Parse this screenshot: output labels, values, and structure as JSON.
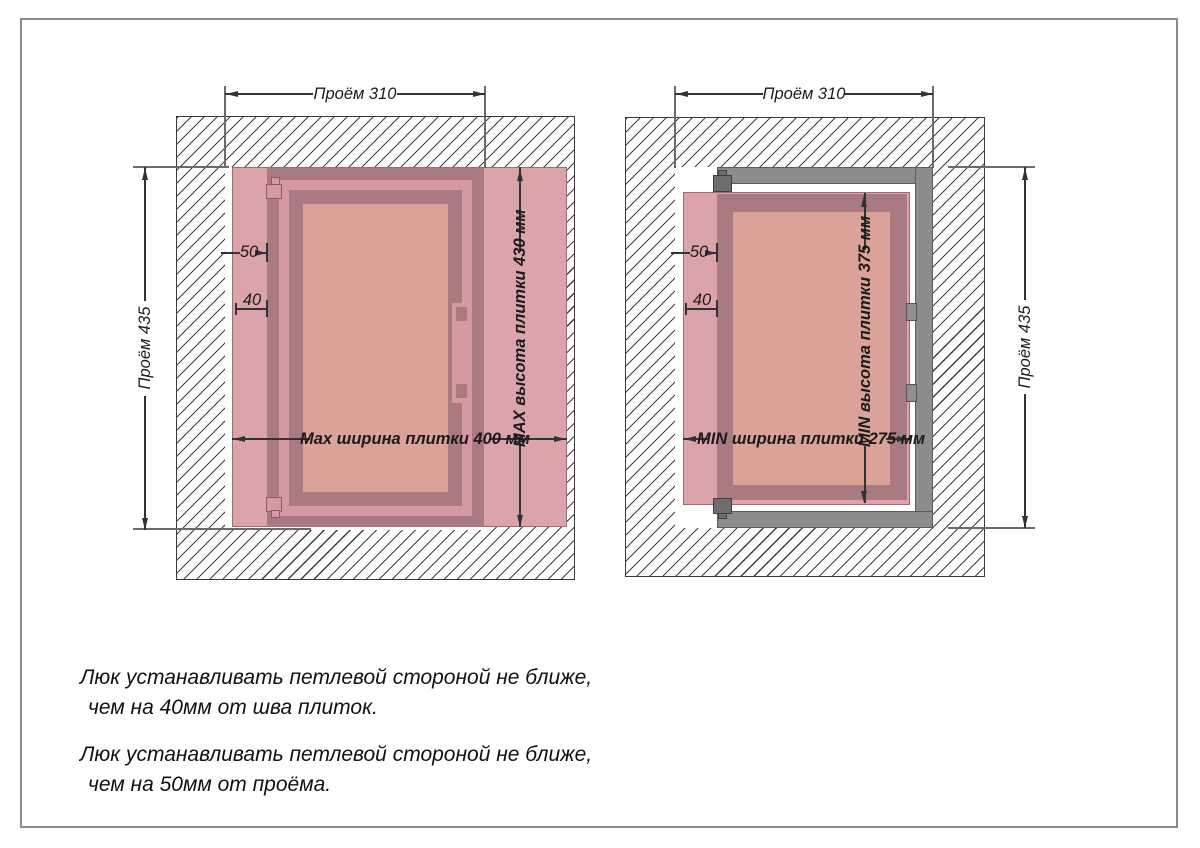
{
  "colors": {
    "tile": "#dba4a9",
    "mauve": "#a97a7f",
    "band": "#d49aa0",
    "panel": "#dba29a",
    "frame_gray": "#8c8c8c",
    "hatch_line": "#3f3f3f",
    "dim_line": "#333333"
  },
  "left": {
    "top_dim": "Проём 310",
    "side_dim": "Проём 435",
    "offset_upper": "50",
    "offset_lower": "40",
    "width_dim": "Max ширина плитки 400 мм",
    "height_dim": "MAX высота плитки 430 мм"
  },
  "right": {
    "top_dim": "Проём 310",
    "side_dim": "Проём 435",
    "offset_upper": "50",
    "offset_lower": "40",
    "width_dim": "MIN ширина плитки 275 мм",
    "height_dim": "MIN высота плитки 375 мм"
  },
  "notes": [
    {
      "line1": "Люк устанавливать петлевой стороной не ближе,",
      "line2": "чем на 40мм от шва плиток."
    },
    {
      "line1": "Люк устанавливать петлевой стороной не ближе,",
      "line2": "чем на 50мм от проёма."
    }
  ]
}
